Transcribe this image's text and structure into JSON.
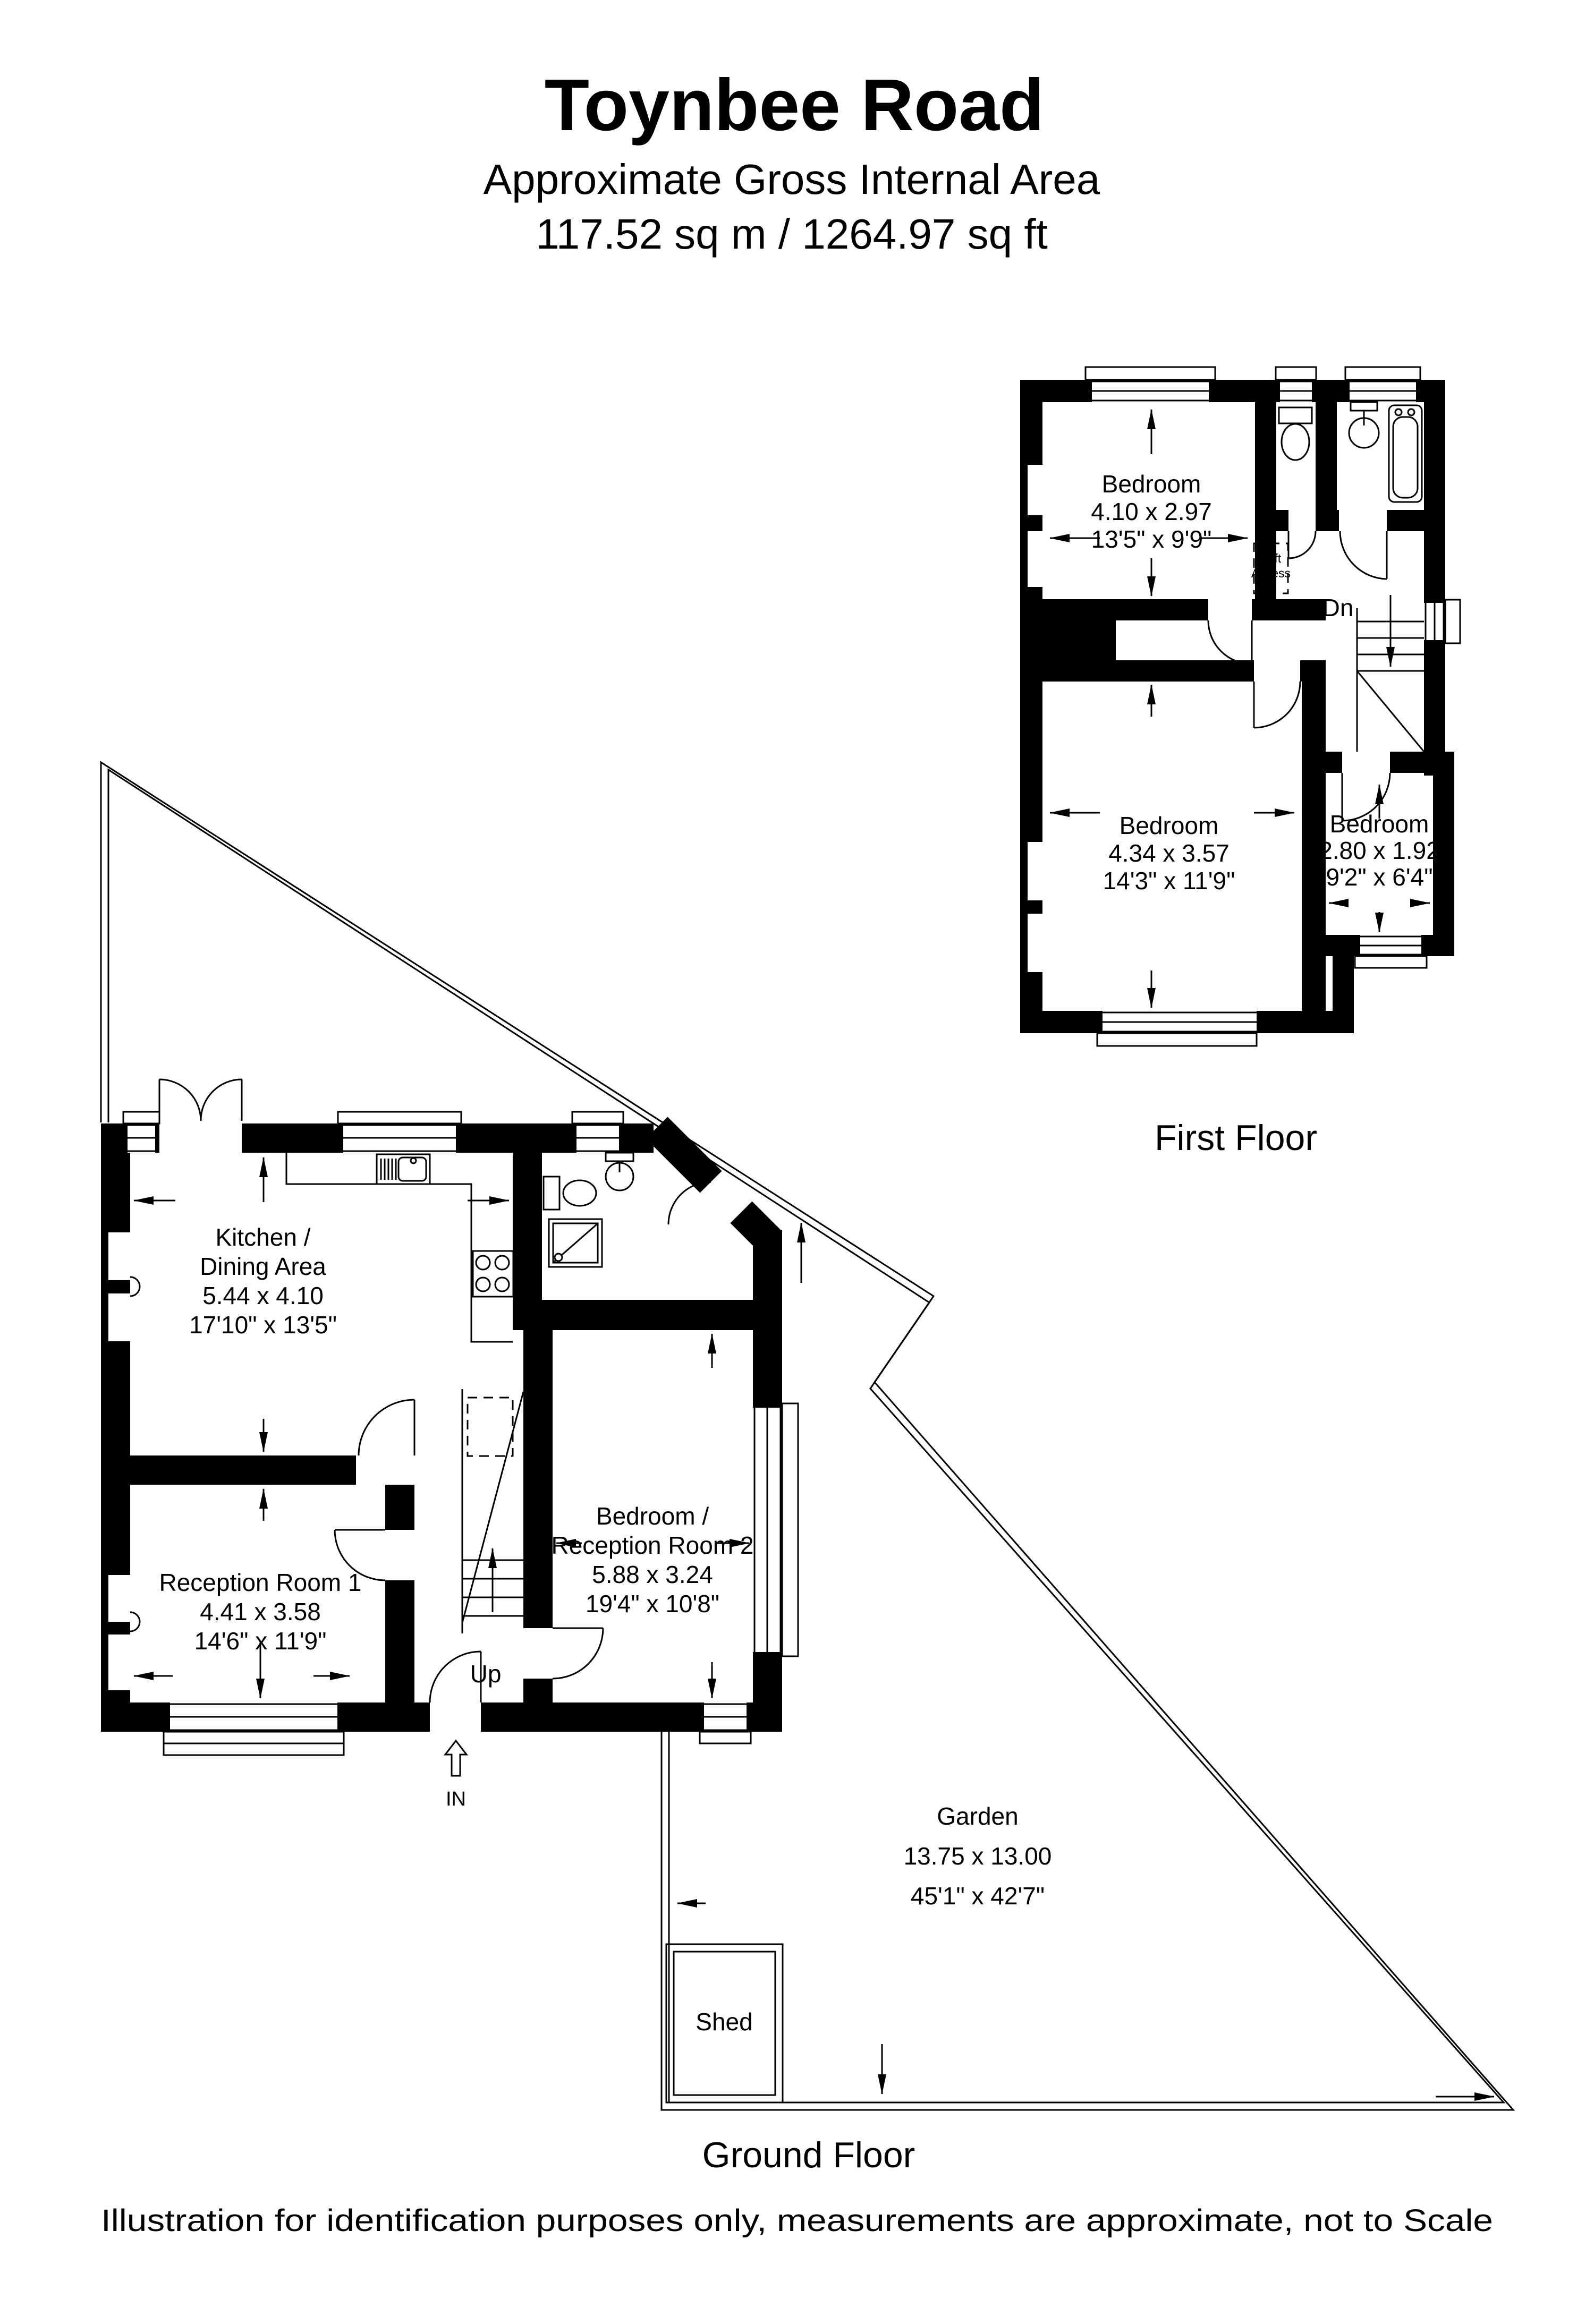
{
  "header": {
    "title": "Toynbee Road",
    "subtitle1": "Approximate Gross Internal Area",
    "subtitle2": "117.52 sq m / 1264.97 sq ft"
  },
  "first_floor": {
    "label": "First Floor",
    "rooms": {
      "bedroom1": {
        "name": "Bedroom",
        "metric": "4.10 x 2.97",
        "imperial": "13'5\" x 9'9\""
      },
      "bedroom2": {
        "name": "Bedroom",
        "metric": "4.34 x 3.57",
        "imperial": "14'3\" x 11'9\""
      },
      "bedroom3": {
        "name": "Bedroom",
        "metric": "2.80 x 1.92",
        "imperial": "9'2\" x 6'4\""
      }
    },
    "annotations": {
      "loft_line1": "Loft",
      "loft_line2": "Access",
      "down": "Dn"
    }
  },
  "ground_floor": {
    "label": "Ground Floor",
    "rooms": {
      "kitchen": {
        "name1": "Kitchen /",
        "name2": "Dining Area",
        "metric": "5.44 x 4.10",
        "imperial": "17'10\" x 13'5\""
      },
      "reception1": {
        "name": "Reception Room 1",
        "metric": "4.41 x 3.58",
        "imperial": "14'6\" x 11'9\""
      },
      "bedroom_reception2": {
        "name1": "Bedroom /",
        "name2": "Reception Room 2",
        "metric": "5.88 x 3.24",
        "imperial": "19'4\" x 10'8\""
      },
      "garden": {
        "name": "Garden",
        "metric": "13.75 x 13.00",
        "imperial": "45'1\" x 42'7\""
      },
      "shed": {
        "name": "Shed"
      }
    },
    "annotations": {
      "up": "Up",
      "entrance": "IN"
    }
  },
  "footer": {
    "disclaimer": "Illustration for identification purposes only, measurements are approximate, not to Scale"
  },
  "colors": {
    "wall": "#000000",
    "line": "#000000",
    "background": "#ffffff"
  }
}
